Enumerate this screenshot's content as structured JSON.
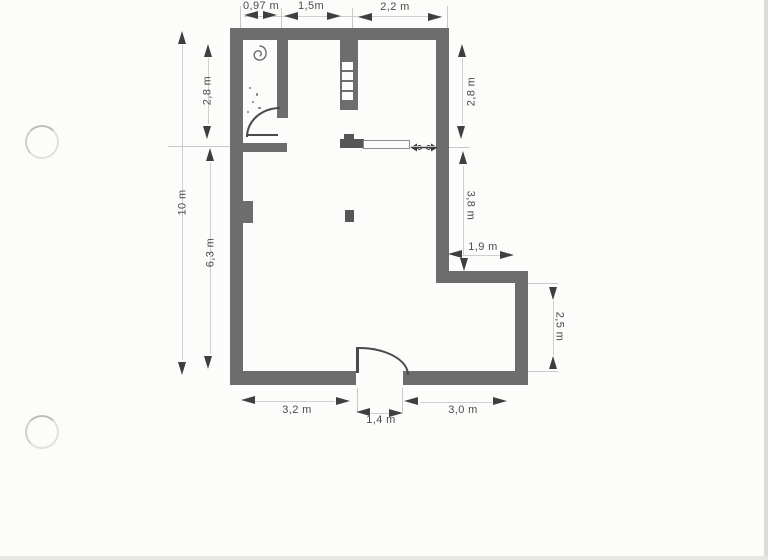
{
  "plan": {
    "kind": "scanned floor plan with dimension annotations",
    "labels": {
      "top_left": "0,97 m",
      "top_mid": "1,5m",
      "top_right": "2,2 m",
      "left_outer": "10 m",
      "left_upper": "2,8 m",
      "left_lower": "6,3 m",
      "right_upper": "2,8 m",
      "right_mid": "3,8 m",
      "right_step": "1,9 m",
      "right_lower": "2,5 m",
      "bottom_left": "3,2 m",
      "bottom_mid": "1,4 m",
      "bottom_right": "3,0 m"
    },
    "colors": {
      "wall": "#6d6d6d",
      "dim_text": "#4b4b4b",
      "arrow": "#3f3f3f",
      "paper": "#fcfcfb"
    },
    "icons": [
      "spiral-icon",
      "stair-treads-icon",
      "double-arrow-icon",
      "door-arc",
      "hole-punch"
    ]
  }
}
